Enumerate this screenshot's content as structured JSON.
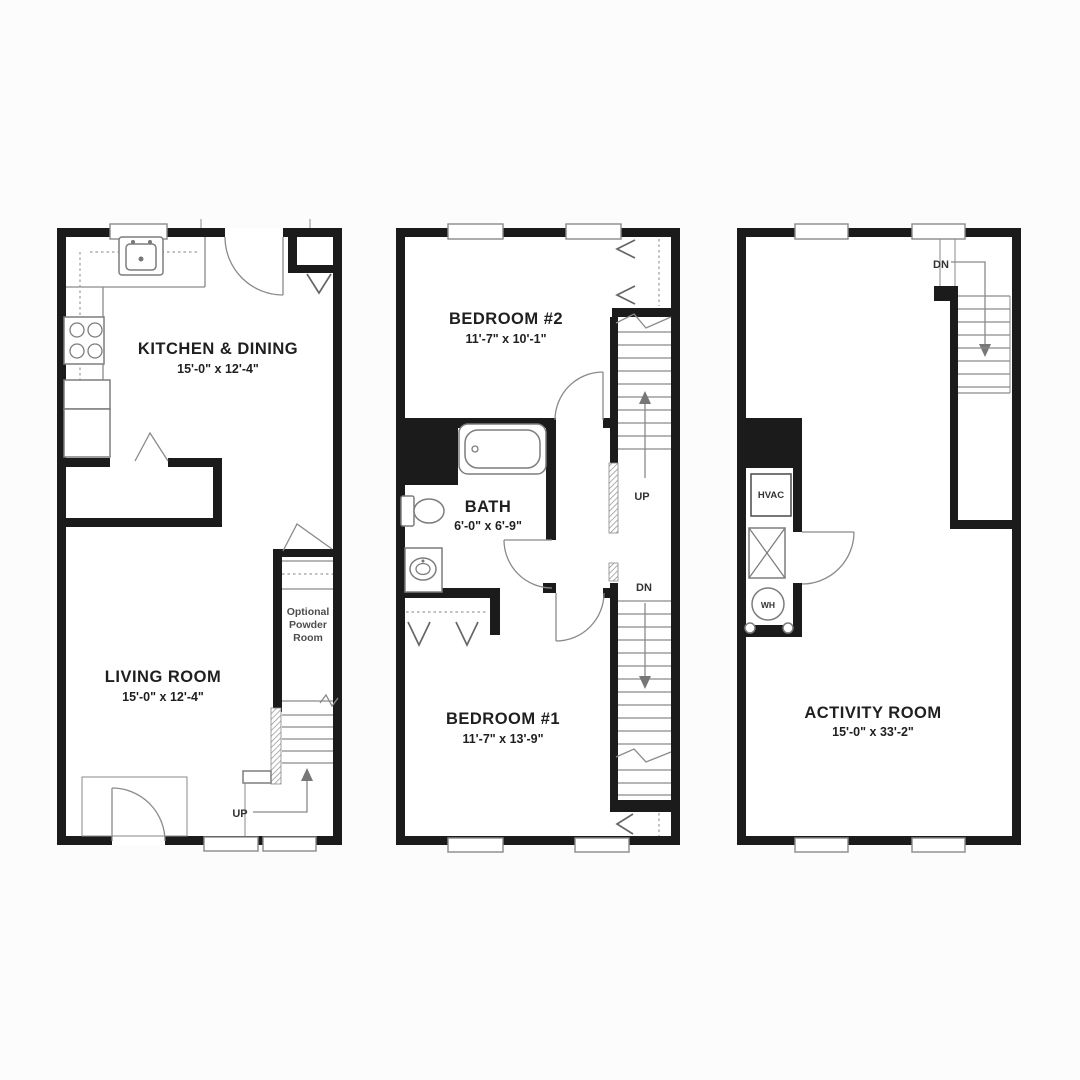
{
  "colors": {
    "background": "#fcfcfc",
    "plan_fill": "#ffffff",
    "wall": "#1b1b1b",
    "line": "#8a8a8a",
    "text": "#1f1f1f",
    "muted_text": "#4d4d4d"
  },
  "floor1": {
    "kitchen": {
      "name": "KITCHEN & DINING",
      "dims": "15'-0\" x 12'-4\""
    },
    "living": {
      "name": "LIVING ROOM",
      "dims": "15'-0\" x 12'-4\""
    },
    "powder": {
      "line1": "Optional",
      "line2": "Powder",
      "line3": "Room"
    },
    "stairs": {
      "up": "UP"
    }
  },
  "floor2": {
    "bedroom2": {
      "name": "BEDROOM #2",
      "dims": "11'-7\" x 10'-1\""
    },
    "bath": {
      "name": "BATH",
      "dims": "6'-0\" x 6'-9\""
    },
    "bedroom1": {
      "name": "BEDROOM #1",
      "dims": "11'-7\" x 13'-9\""
    },
    "stairs": {
      "up": "UP",
      "down": "DN"
    }
  },
  "floor3": {
    "activity": {
      "name": "ACTIVITY ROOM",
      "dims": "15'-0\" x 33'-2\""
    },
    "hvac": "HVAC",
    "water_heater": "WH",
    "stairs": {
      "down": "DN"
    }
  }
}
